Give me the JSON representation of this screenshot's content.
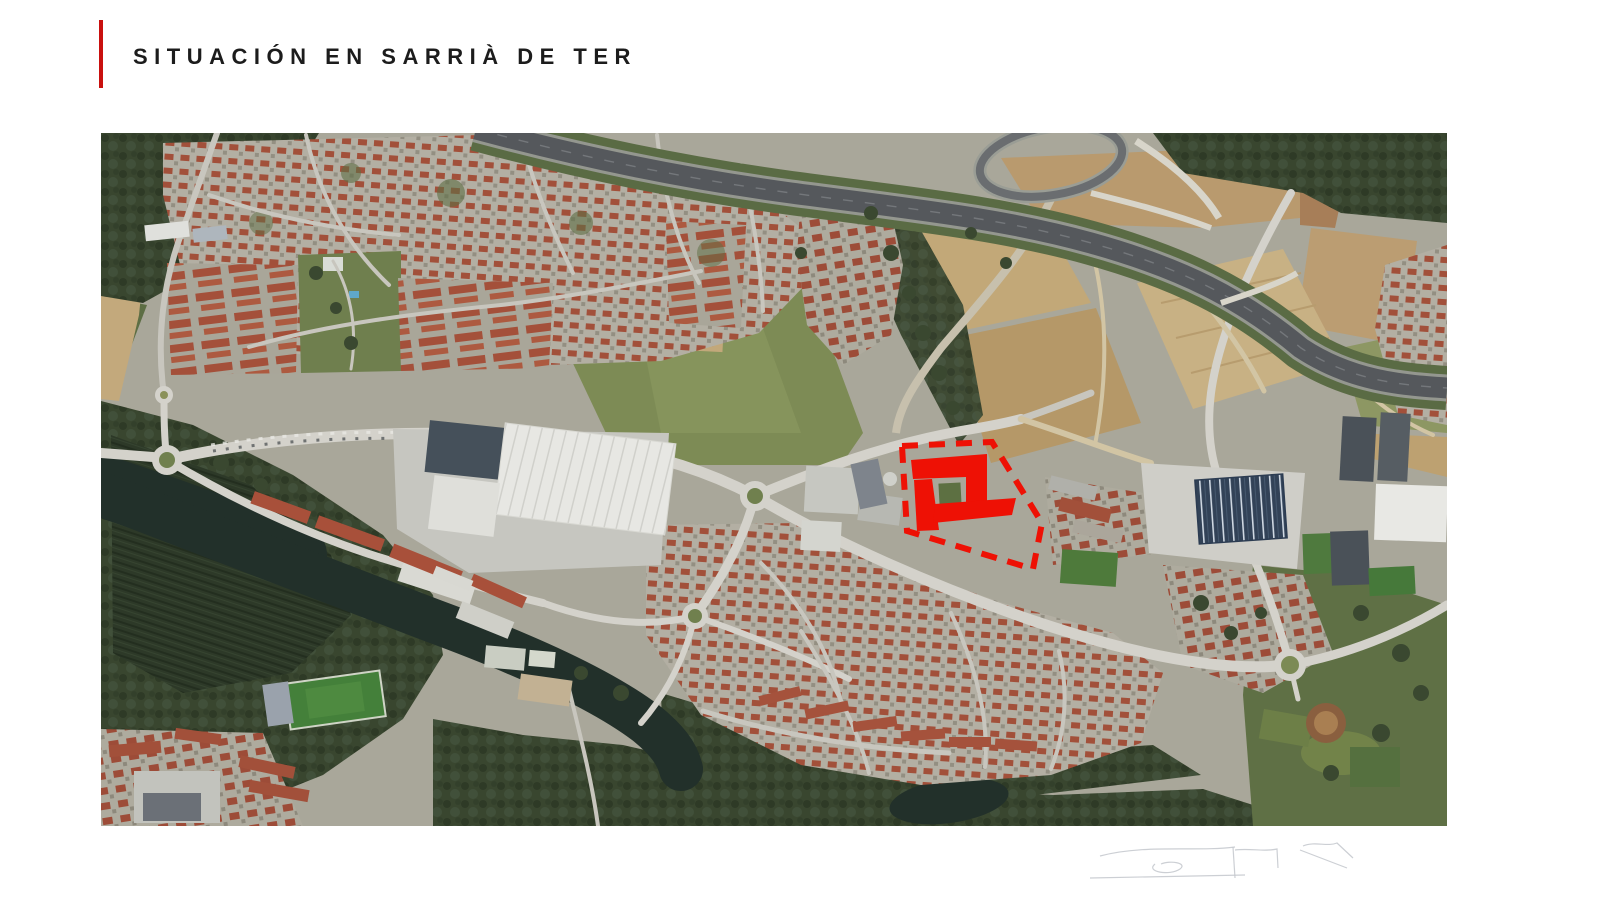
{
  "slide": {
    "title": "SITUACIÓN EN SARRIÀ DE TER",
    "title_color": "#1c1c1c",
    "accent_color": "#c9100e",
    "background_color": "#ffffff"
  },
  "map": {
    "kind": "aerial-satellite-photo",
    "site_marker": {
      "color": "#ee1105",
      "outline_style": "dashed",
      "fill_shapes": "building-footprints"
    }
  }
}
